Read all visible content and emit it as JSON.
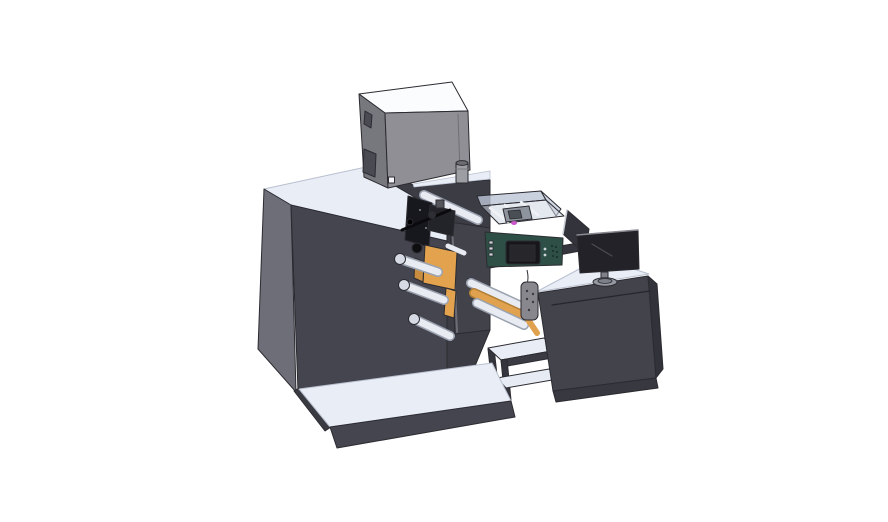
{
  "scene": {
    "description": "3D CAD render of a label printing / rewinding machine line with printer unit, unwind rollers, HMI control box, outfeed stand and an operator desk with monitor on a white background",
    "background": "#ffffff"
  },
  "colors": {
    "top_light": "#e9edf6",
    "cabinet_front": "#45454f",
    "cabinet_side": "#6e6e79",
    "housing": "#3c3c45",
    "plate": "#42424b",
    "deck": "#35353d",
    "box_top": "#fbfcfe",
    "box_front": "#8f8f95",
    "box_side": "#77777e",
    "window_dark": "#4a4a52",
    "orange": "#e2a24e",
    "orange_dark": "#c88d3e",
    "roller_white": "#e8ebf2",
    "green_panel": "#2e4f45",
    "display_black": "#17171a",
    "screen_inner": "#26262b",
    "cover_glass": "#bdc6d6",
    "cover_floor": "#cdd5e2",
    "monitor_screen": "#222228",
    "stand_gray": "#9598a0",
    "pendant_gray": "#87878d",
    "magenta": "#c957c9",
    "black_parts": "#17181d",
    "desk_front": "#43434c",
    "desk_side": "#32323a",
    "base_strip": "#383840",
    "bottle_gray": "#9d9da4",
    "panel_shield": "#33333b"
  },
  "parts": {
    "machine_cabinet": "main machine cabinet",
    "printer_box": "printer unit on top",
    "bottle": "small canister on cabinet top",
    "print_head": "print head assembly",
    "top_roller": "upper guide roller",
    "unwind_plates": "orange unwind side plates",
    "unwind_rollers": "white unwind rollers",
    "access_plate": "front access plate",
    "glass_cover": "transparent inspection cover",
    "inner_mechanism": "mechanism under cover",
    "control_box": "green HMI control box",
    "hmi_display": "HMI display screen",
    "web_path": "label web over rollers",
    "outfeed_stand": "outfeed roller stand",
    "pendant": "pendant hand control",
    "base_platform": "machine base platform",
    "operator_desk": "operator desk",
    "side_shield": "side shield panel",
    "desk_monitor": "desktop monitor"
  }
}
